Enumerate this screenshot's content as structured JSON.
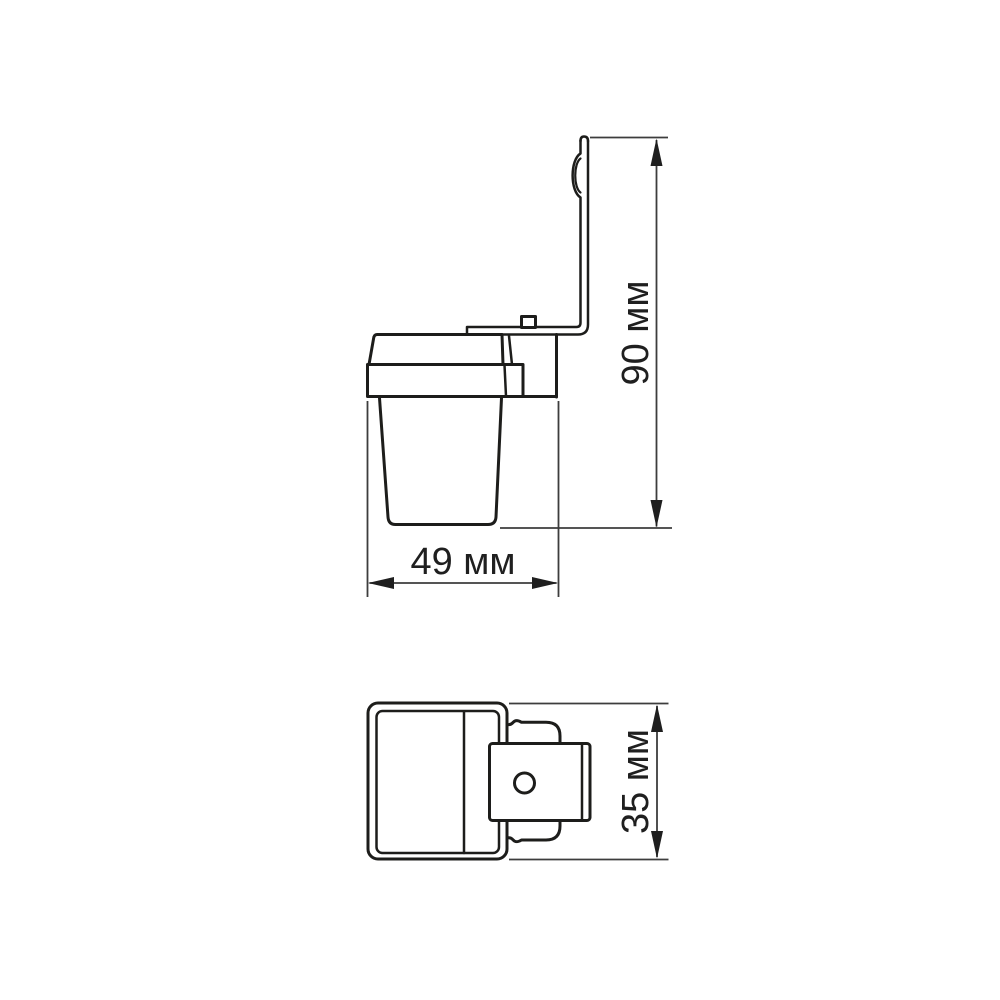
{
  "drawing": {
    "colors": {
      "background": "#ffffff",
      "line": "#1d1d1b",
      "dimension": "#3d3d3d",
      "text": "#1f1f1f"
    },
    "dimensions": {
      "width": {
        "value": 49,
        "unit": "мм",
        "label": "49 мм"
      },
      "height": {
        "value": 90,
        "unit": "мм",
        "label": "90 мм"
      },
      "depth": {
        "value": 35,
        "unit": "мм",
        "label": "35 мм"
      }
    }
  }
}
